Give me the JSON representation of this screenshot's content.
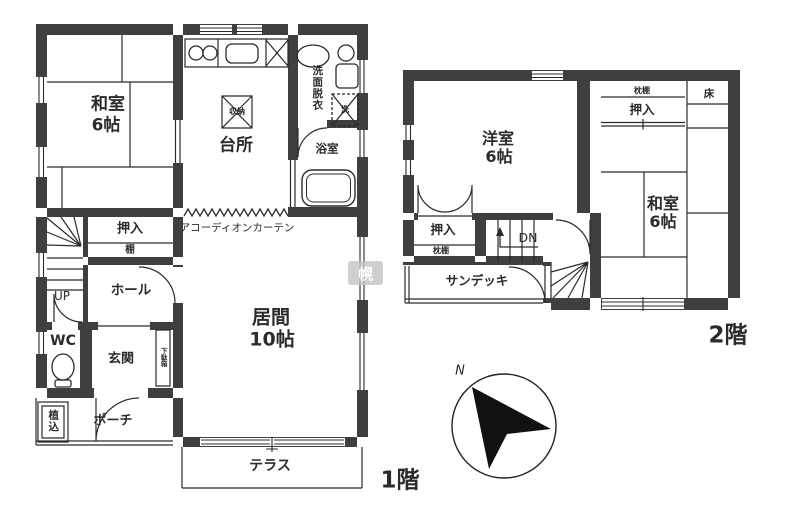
{
  "colors": {
    "wall": "#3f3f3f",
    "line": "#2b2b2b",
    "text": "#2b2b2b",
    "background": "#ffffff"
  },
  "floor1": {
    "floor_label": "1階",
    "washitsu_name": "和室",
    "washitsu_size": "6帖",
    "kitchen": "台所",
    "kitchen_storage": "収納",
    "washroom": "洗面脱衣",
    "laundry_mark": "洗",
    "bathroom": "浴室",
    "closet": "押入",
    "shelf": "棚",
    "accordion_curtain": "アコーディオンカーテン",
    "living_name": "居間",
    "living_size": "10帖",
    "stairs_label": "UP",
    "hall": "ホール",
    "wc": "WC",
    "entrance": "玄関",
    "shoe_cabinet": "下駄箱",
    "planting": "植込",
    "porch": "ポーチ",
    "terrace": "テラス"
  },
  "floor2": {
    "floor_label": "2階",
    "western_room_name": "洋室",
    "western_room_size": "6帖",
    "pillow_shelf_top": "枕棚",
    "closet_top": "押入",
    "tokonoma": "床",
    "washitsu_name": "和室",
    "washitsu_size": "6帖",
    "closet_left": "押入",
    "pillow_shelf_left": "枕棚",
    "stairs_label": "DN",
    "sundeck": "サンデッキ"
  },
  "compass": {
    "north_label": "N"
  },
  "watermark": "幌"
}
